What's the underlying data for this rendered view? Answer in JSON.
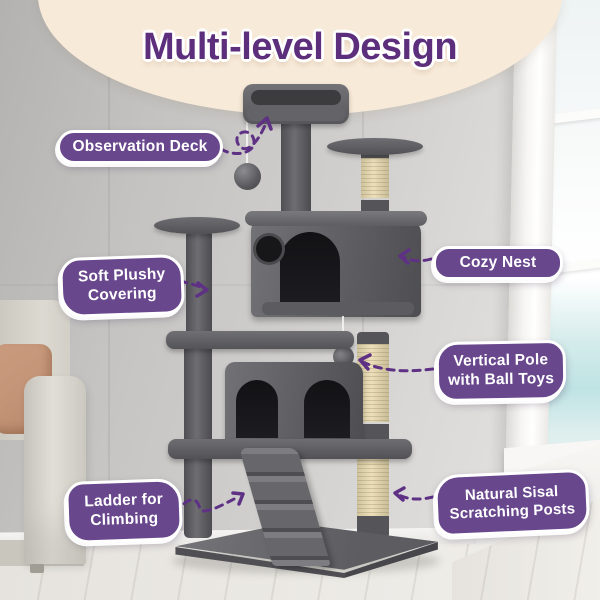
{
  "title": "Multi-level Design",
  "features": [
    {
      "label": "Observation Deck"
    },
    {
      "label": "Cozy Nest"
    },
    {
      "label": "Soft Plushy Covering"
    },
    {
      "label": "Vertical Pole with Ball Toys"
    },
    {
      "label": "Ladder for Climbing"
    },
    {
      "label": "Natural Sisal Scratching Posts"
    }
  ],
  "colors": {
    "banner_bg": "#f8ead8",
    "title_text": "#5c2e7c",
    "label_bg": "#68478d",
    "label_text": "#ffffff",
    "arrow": "#5e3185",
    "sisal": "#e4d8b4",
    "plush": "#5d5d60"
  }
}
